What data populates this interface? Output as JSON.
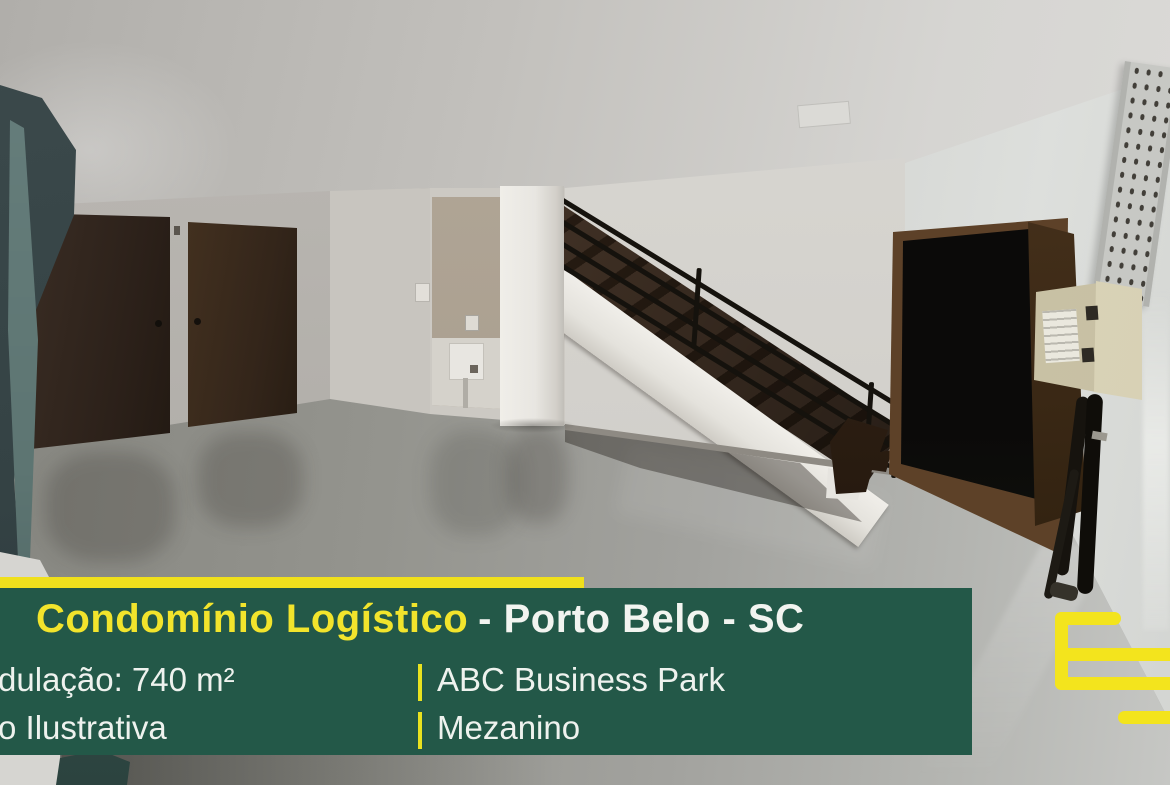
{
  "banner": {
    "accent_bar_color": "#f0e01c",
    "panel_color": "#235848",
    "title": {
      "highlight": "Condomínio Logístico",
      "highlight_color": "#f2e42c",
      "rest": "- Porto Belo - SC",
      "rest_color": "#f2f4f0"
    },
    "separator_glyph": "|",
    "separator_color": "#e9e21f",
    "text_color": "#eef2ee",
    "rows": [
      {
        "left": "dulação: 740 m²",
        "right": "ABC Business Park"
      },
      {
        "left": "o Ilustrativa",
        "right": "Mezanino"
      }
    ]
  },
  "logo": {
    "name": "yellow-e-logo-mark",
    "color": "#f3e41d"
  },
  "photo": {
    "elements": [
      "ceiling",
      "left-wall",
      "wood-door",
      "wood-door",
      "utility-alcove",
      "white-pillar",
      "staircase-treads",
      "white-stringer",
      "black-railing",
      "dark-doorway",
      "open-wood-door",
      "electrical-box",
      "hanging-cables",
      "perforated-cable-tray",
      "glossy-gray-floor",
      "foreground-panel"
    ]
  }
}
